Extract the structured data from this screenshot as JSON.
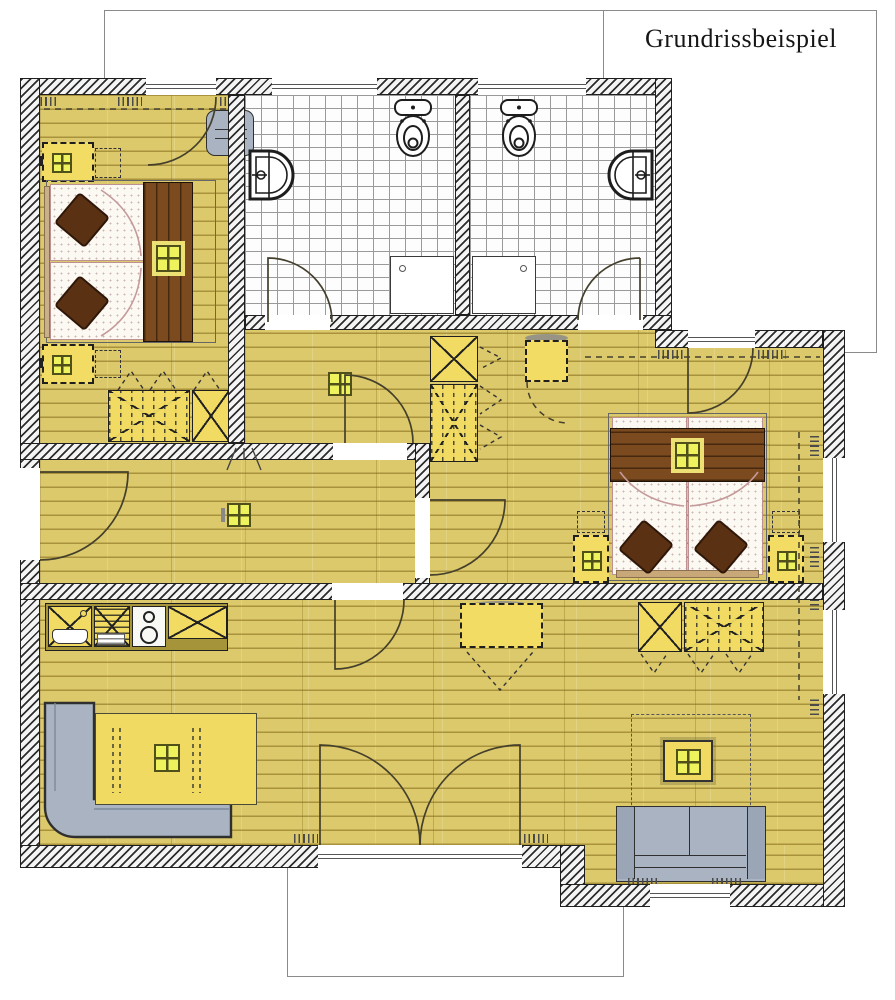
{
  "title": {
    "text": "Grundrissbeispiel"
  },
  "colors": {
    "floor_wood": "#dcc96b",
    "plank_line": "#7d6416",
    "wall_fill": "#f4f4f4",
    "wall_hatch": "#2d2d2d",
    "tile_floor": "#fdfdfd",
    "tile_line": "#9a9a9a",
    "furniture_yellow": "#f1db63",
    "bed_wood_dark": "#7b4a1e",
    "pillow_brown": "#5b3114",
    "sofa_gray": "#a9b3c1",
    "lamp_pane": "#eef25c",
    "lamp_frame": "#50501a",
    "outline": "#1f1f1f"
  }
}
